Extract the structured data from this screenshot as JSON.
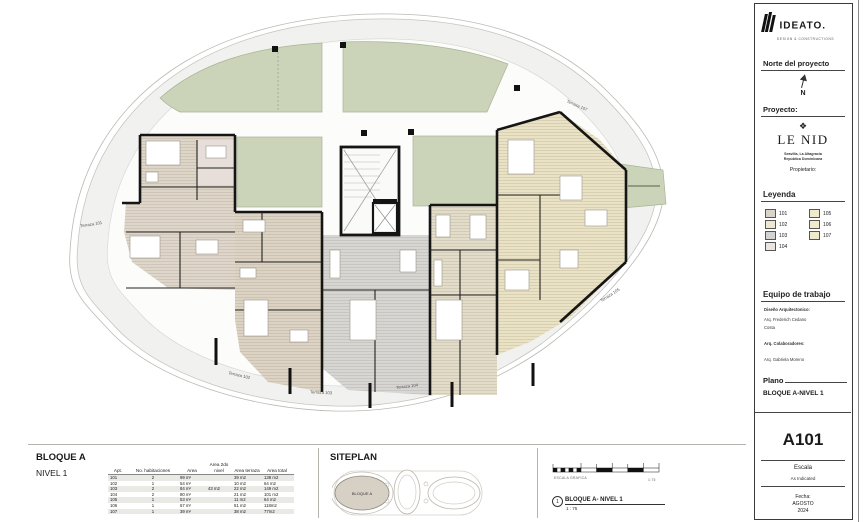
{
  "logo": {
    "brand": "IDEATO.",
    "tagline": "DESIGN & CONSTRUCTIONS"
  },
  "sidebar": {
    "north": {
      "title": "Norte del proyecto",
      "letter": "N"
    },
    "project": {
      "label": "Proyecto:",
      "ornament": "❖",
      "name": "LE NID",
      "subtitle1": "Seavilla, La Altagracia",
      "subtitle2": "República Dominicana",
      "owner_label": "Propietario:"
    },
    "legend": {
      "title": "Leyenda",
      "items": [
        {
          "label": "101",
          "color": "#d9d4c9"
        },
        {
          "label": "102",
          "color": "#eee8d0"
        },
        {
          "label": "103",
          "color": "#d3d3d1"
        },
        {
          "label": "104",
          "color": "#ece5df"
        },
        {
          "label": "105",
          "color": "#efe9cd"
        },
        {
          "label": "106",
          "color": "#efe9cd"
        },
        {
          "label": "107",
          "color": "#efe9cd"
        }
      ]
    },
    "team": {
      "title": "Equipo de trabajo",
      "role1": "Diseño Arquitectonico:",
      "name1": "Arq. Frederich Cedano",
      "name1b": "Costa",
      "role2": "Arq. Colaboradores:",
      "name2": "Arq. Gabriela Moreno"
    },
    "plano": {
      "label": "Plano",
      "value": "BLOQUE A-NIVEL 1"
    },
    "sheet": {
      "number": "A101",
      "scale_label": "Escala",
      "scale_value": "As Indicated",
      "date_label": "Fecha:",
      "date_line1": "AGOSTO",
      "date_line2": "2024"
    }
  },
  "bottom": {
    "block_title": "BLOQUE A",
    "level_title": "NIVEL 1",
    "table": {
      "headers": [
        "Apt.",
        "No. habitaciones",
        "Area",
        "Area 2do nivel",
        "Area terraza",
        "Area total"
      ],
      "rows": [
        [
          "101",
          "2",
          "99 m²",
          "",
          "39 m2",
          "138 m2"
        ],
        [
          "102",
          "1",
          "54 m²",
          "",
          "10 m2",
          "64 m2"
        ],
        [
          "103",
          "2",
          "84 m²",
          "43 m2",
          "22 m2",
          "149 m2"
        ],
        [
          "104",
          "2",
          "80 m²",
          "",
          "21 m2",
          "101 m2"
        ],
        [
          "105",
          "1",
          "53 m²",
          "",
          "11 m2",
          "64 m2"
        ],
        [
          "106",
          "1",
          "67 m²",
          "",
          "51 m2",
          "118m2"
        ],
        [
          "107",
          "1",
          "39 m²",
          "",
          "38 m2",
          "77m2"
        ]
      ]
    },
    "siteplan": {
      "title": "SITEPLAN",
      "block_label": "BLOQUE A"
    },
    "view_title": {
      "number": "1",
      "label": "BLOQUE A- NIVEL 1",
      "scale": "1 : 75",
      "scalebar_label": "ESCALA GRAFICA",
      "scalebar_value": "1:75"
    }
  },
  "plan": {
    "terrace_labels": [
      "Terraza 101",
      "Terraza 102",
      "Terraza 103",
      "Terraza 104",
      "Terraza 105",
      "Terraza 107"
    ],
    "colors": {
      "garden_green": "#cbd4b8",
      "terrace_gray": "#f1f1ef",
      "room_beige": "#ddd5c8",
      "room_tan": "#e3dac6",
      "room_gray": "#d6d5d2",
      "room_cream": "#e9e2c4",
      "wall_black": "#151515"
    }
  }
}
